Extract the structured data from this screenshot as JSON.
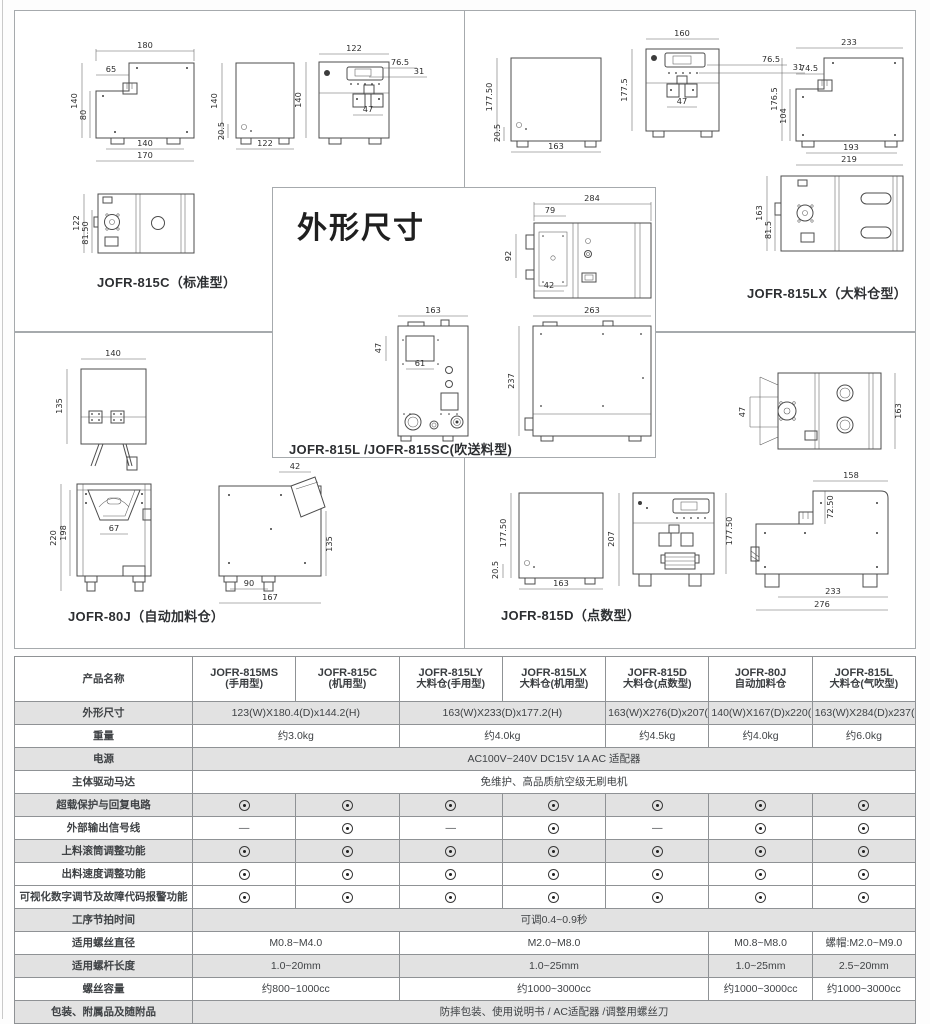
{
  "title": "外形尺寸",
  "models": {
    "c815": {
      "label": "JOFR-815C（标准型）",
      "side": {
        "w": "180",
        "notch": "65",
        "h": "140",
        "h2": "80",
        "b1": "140",
        "b2": "170"
      },
      "back": {
        "h": "140",
        "foot": "20.5",
        "w": "122"
      },
      "front": {
        "w": "122",
        "c1": "76.5",
        "c2": "31",
        "h": "140",
        "inner": "47"
      },
      "top": {
        "h": "122",
        "h2": "81.50"
      }
    },
    "lx815": {
      "label": "JOFR-815LX（大料仓型）",
      "back": {
        "h": "177.50",
        "foot": "20.5",
        "w": "163"
      },
      "front": {
        "w": "160",
        "c1": "76.5",
        "c2": "31",
        "h": "177.5",
        "inner": "47"
      },
      "side": {
        "w": "233",
        "notch": "74.5",
        "h": "176.5",
        "h2": "104",
        "b1": "193",
        "b2": "219"
      },
      "top": {
        "h": "163",
        "h2": "81.5"
      }
    },
    "l815": {
      "label": "JOFR-815L /JOFR-815SC(吹送料型)",
      "top": {
        "w": "284",
        "w2": "79",
        "h": "92",
        "b": "42"
      },
      "front": {
        "w": "163",
        "box_h": "47",
        "box_w": "61"
      },
      "side": {
        "w": "263",
        "h": "237"
      }
    },
    "j80": {
      "label": "JOFR-80J（自动加料仓）",
      "top": {
        "w": "140",
        "h": "135"
      },
      "front": {
        "h": "220",
        "h2": "198",
        "inner": "67"
      },
      "side": {
        "chute": "42",
        "h": "135",
        "b1": "90",
        "b2": "167"
      }
    },
    "d815": {
      "label": "JOFR-815D（点数型）",
      "top": {
        "left": "47",
        "right": "163"
      },
      "back": {
        "h": "177.50",
        "foot": "20.5",
        "w": "163"
      },
      "front": {
        "h": "207",
        "right": "177.50"
      },
      "side": {
        "w": "158",
        "step": "72.50",
        "b1": "233",
        "b2": "276"
      }
    }
  },
  "table": {
    "header_label": "产品名称",
    "products": [
      {
        "name": "JOFR-815MS",
        "sub": "(手用型)"
      },
      {
        "name": "JOFR-815C",
        "sub": "(机用型)"
      },
      {
        "name": "JOFR-815LY",
        "sub": "大料仓(手用型)"
      },
      {
        "name": "JOFR-815LX",
        "sub": "大料仓(机用型)"
      },
      {
        "name": "JOFR-815D",
        "sub": "大料仓(点数型)"
      },
      {
        "name": "JOFR-80J",
        "sub": "自动加料仓"
      },
      {
        "name": "JOFR-815L",
        "sub": "大料仓(气吹型)"
      }
    ],
    "symbols": {
      "dash": "—",
      "dot": "included"
    },
    "rows": [
      {
        "label": "外形尺寸",
        "cells": [
          {
            "t": "123(W)X180.4(D)x144.2(H)",
            "span": 2
          },
          {
            "t": "163(W)X233(D)x177.2(H)",
            "span": 2
          },
          {
            "t": "163(W)X276(D)x207(H)",
            "span": 1
          },
          {
            "t": "140(W)X167(D)x220(H)",
            "span": 1
          },
          {
            "t": "163(W)X284(D)x237(H)",
            "span": 1
          }
        ]
      },
      {
        "label": "重量",
        "cells": [
          {
            "t": "约3.0kg",
            "span": 2
          },
          {
            "t": "约4.0kg",
            "span": 2
          },
          {
            "t": "约4.5kg",
            "span": 1
          },
          {
            "t": "约4.0kg",
            "span": 1
          },
          {
            "t": "约6.0kg",
            "span": 1
          }
        ]
      },
      {
        "label": "电源",
        "cells": [
          {
            "t": "AC100V~240V DC15V 1A AC 适配器",
            "span": 7
          }
        ]
      },
      {
        "label": "主体驱动马达",
        "cells": [
          {
            "t": "免维护、高品质航空级无刷电机",
            "span": 7
          }
        ]
      },
      {
        "label": "超载保护与回复电路",
        "marks": [
          "dot",
          "dot",
          "dot",
          "dot",
          "dot",
          "dot",
          "dot"
        ]
      },
      {
        "label": "外部输出信号线",
        "marks": [
          "dash",
          "dot",
          "dash",
          "dot",
          "dash",
          "dot",
          "dot"
        ]
      },
      {
        "label": "上料滚筒调整功能",
        "marks": [
          "dot",
          "dot",
          "dot",
          "dot",
          "dot",
          "dot",
          "dot"
        ]
      },
      {
        "label": "出料速度调整功能",
        "marks": [
          "dot",
          "dot",
          "dot",
          "dot",
          "dot",
          "dot",
          "dot"
        ]
      },
      {
        "label": "可视化数字调节及故障代码报警功能",
        "marks": [
          "dot",
          "dot",
          "dot",
          "dot",
          "dot",
          "dot",
          "dot"
        ]
      },
      {
        "label": "工序节拍时间",
        "cells": [
          {
            "t": "可调0.4~0.9秒",
            "span": 7
          }
        ]
      },
      {
        "label": "适用螺丝直径",
        "cells": [
          {
            "t": "M0.8~M4.0",
            "span": 2
          },
          {
            "t": "M2.0~M8.0",
            "span": 3
          },
          {
            "t": "M0.8~M8.0",
            "span": 1
          },
          {
            "t": "螺帽:M2.0~M9.0",
            "span": 1
          }
        ]
      },
      {
        "label": "适用螺杆长度",
        "cells": [
          {
            "t": "1.0~20mm",
            "span": 2
          },
          {
            "t": "1.0~25mm",
            "span": 3
          },
          {
            "t": "1.0~25mm",
            "span": 1
          },
          {
            "t": "2.5~20mm",
            "span": 1
          }
        ]
      },
      {
        "label": "螺丝容量",
        "cells": [
          {
            "t": "约800~1000cc",
            "span": 2
          },
          {
            "t": "约1000~3000cc",
            "span": 3
          },
          {
            "t": "约1000~3000cc",
            "span": 1
          },
          {
            "t": "约1000~3000cc",
            "span": 1
          }
        ]
      },
      {
        "label": "包装、附属品及随附品",
        "cells": [
          {
            "t": "防摔包装、使用说明书 / AC适配器 /调整用螺丝刀",
            "span": 7
          }
        ]
      }
    ]
  }
}
